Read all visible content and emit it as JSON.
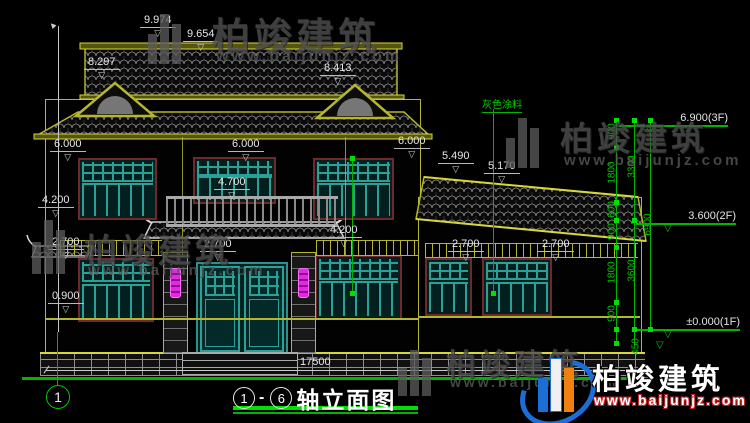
{
  "drawing": {
    "title": {
      "axis_start": "1",
      "separator": "-",
      "axis_end": "6",
      "text": "轴立面图"
    },
    "axis_bubble": "1",
    "paint_label": "灰色涂料"
  },
  "icons": {
    "dim_arrow": "▽",
    "level_arrow": "▽",
    "leader_arrow": "▲"
  },
  "dimensions": {
    "ridge_top": "9.974",
    "ridge": "9.654",
    "gable_left": "8.297",
    "gable_right": "8.413",
    "left": [
      "6.000",
      "4.200",
      "2.700",
      "0.900"
    ],
    "center": [
      "6.000",
      "4.700",
      "2.700"
    ],
    "right_block": [
      "6.000",
      "4.200"
    ],
    "wing": [
      "5.490",
      "5.170",
      "2.700",
      "2.700"
    ],
    "total_width": "17500",
    "chain_inner": [
      "900",
      "1800",
      "600",
      "900",
      "1800",
      "900",
      "450"
    ],
    "chain_mid": [
      "3300",
      "3600"
    ],
    "chain_outer": [
      "6900"
    ],
    "levels": [
      "6.900(3F)",
      "3.600(2F)",
      "±0.000(1F)"
    ]
  },
  "watermark": {
    "brand": "柏竣建筑",
    "url": "www.baijunjz.com"
  },
  "logo": {
    "brand": "柏竣建筑",
    "url": "www.baijunjz.com"
  },
  "colors": {
    "outline_yellow": "#b5b52e",
    "accent_green": "#00c800",
    "lattice_teal": "#2aa198",
    "frame_maroon": "#6e2a2a",
    "lamp_magenta": "#e02ae0",
    "dim_white": "#e6e6e6"
  }
}
